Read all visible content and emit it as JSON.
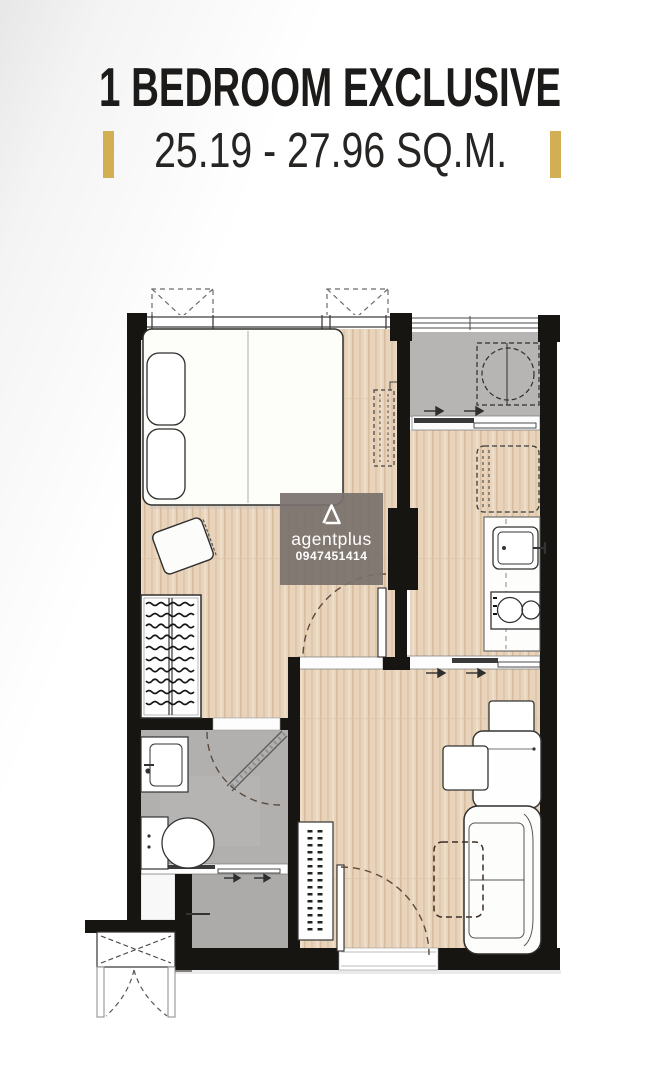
{
  "header": {
    "title": "1 BEDROOM EXCLUSIVE",
    "subtitle": "25.19 - 27.96 SQ.M."
  },
  "watermark": {
    "brand": "agentplus",
    "phone": "0947451414"
  },
  "plan": {
    "legend": [
      "bedroom",
      "balcony-with-washing-machine",
      "kitchen",
      "living-dining",
      "bathroom",
      "foyer-dressing-area",
      "ac-ledge"
    ],
    "colors": {
      "wall": "#171512",
      "wood_floor": "#e8d4bc",
      "tile_gray": "#b4b3b1",
      "accent_gold": "#d2ae55",
      "door_arc": "#5d4a3e",
      "watermark_bg": "#7a716c",
      "title_text": "#1d1b19"
    }
  }
}
